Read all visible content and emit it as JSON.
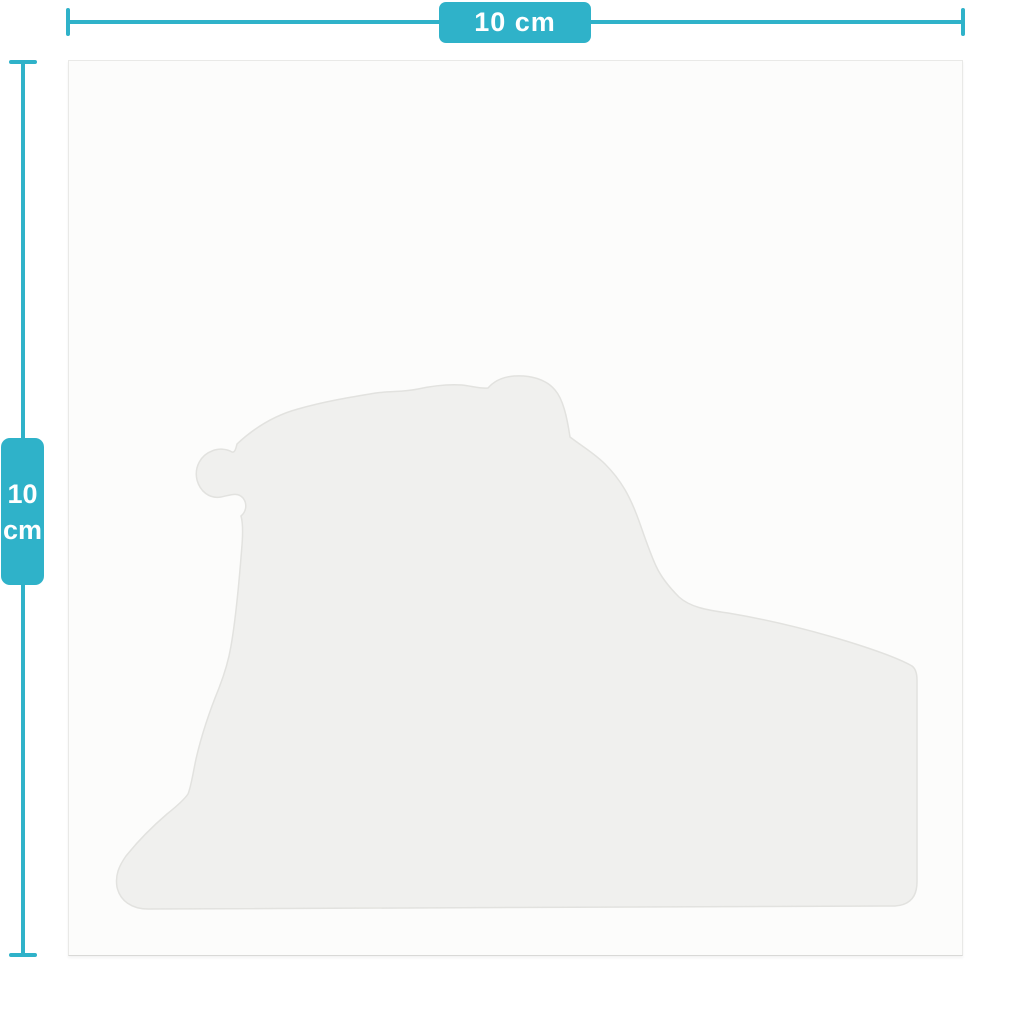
{
  "accent_color": "#2fb2c9",
  "canvas": {
    "shape": "lion-silhouette",
    "shape_fill": "#f0f0ee",
    "background": "#fcfcfb"
  },
  "dimensions": {
    "width": {
      "label": "10 cm"
    },
    "height": {
      "value": "10",
      "unit": "cm"
    }
  }
}
